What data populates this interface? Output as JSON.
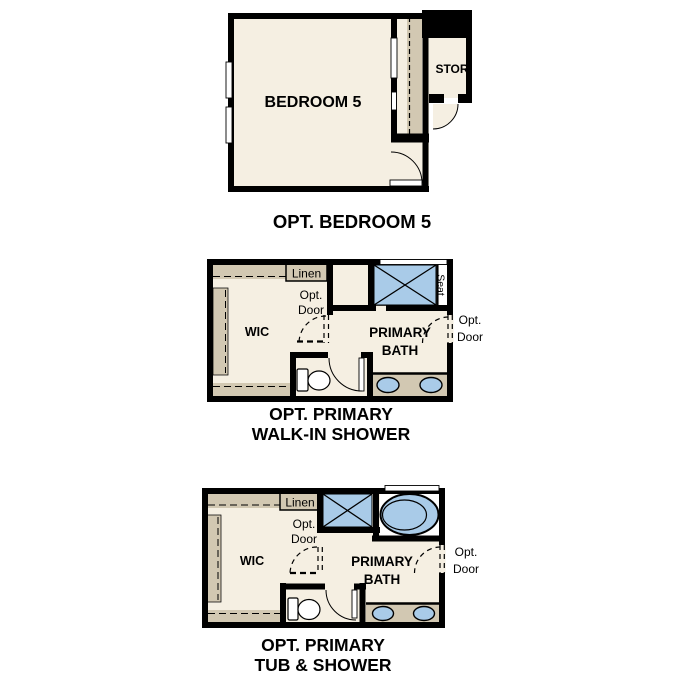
{
  "colors": {
    "wall": "#000000",
    "floor": "#F5EFE2",
    "millwork_tan": "#D2C8B2",
    "fixture_blue": "#A9CBE8",
    "background": "#FFFFFF"
  },
  "plan_bedroom5": {
    "title": "OPT. BEDROOM 5",
    "bedroom_label": "BEDROOM 5",
    "storage_label": "STOR"
  },
  "plan_walkin_shower": {
    "title_line1": "OPT. PRIMARY",
    "title_line2": "WALK-IN SHOWER",
    "wic_label": "WIC",
    "linen_label": "Linen",
    "bath_line1": "PRIMARY",
    "bath_line2": "BATH",
    "seat_label": "Seat",
    "opt_door_wic_line1": "Opt.",
    "opt_door_wic_line2": "Door",
    "opt_door_entry_line1": "Opt.",
    "opt_door_entry_line2": "Door"
  },
  "plan_tub_shower": {
    "title_line1": "OPT. PRIMARY",
    "title_line2": "TUB & SHOWER",
    "wic_label": "WIC",
    "linen_label": "Linen",
    "bath_line1": "PRIMARY",
    "bath_line2": "BATH",
    "opt_door_wic_line1": "Opt.",
    "opt_door_wic_line2": "Door",
    "opt_door_entry_line1": "Opt.",
    "opt_door_entry_line2": "Door"
  }
}
